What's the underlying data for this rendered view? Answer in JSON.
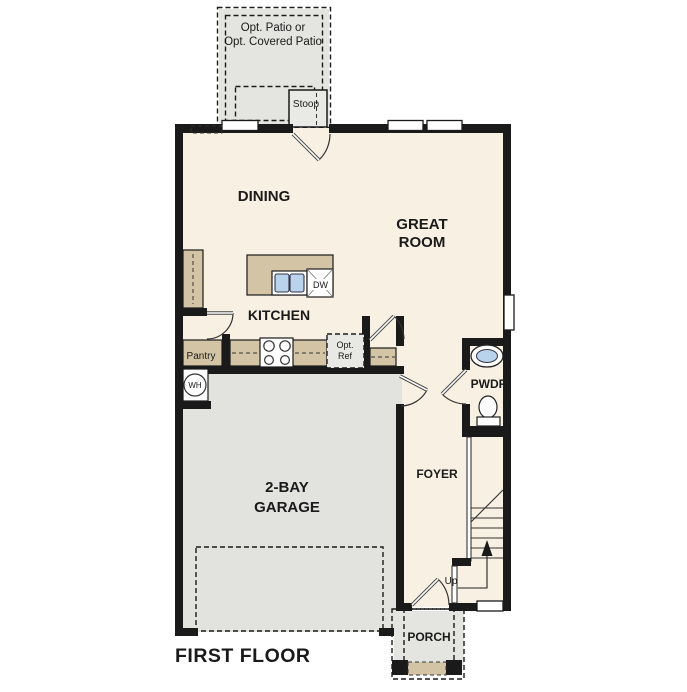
{
  "plan": {
    "title": "FIRST FLOOR",
    "patio": {
      "line1": "Opt. Patio or",
      "line2": "Opt. Covered Patio"
    },
    "stoop": "Stoop",
    "dining": "DINING",
    "great_room": {
      "line1": "GREAT",
      "line2": "ROOM"
    },
    "kitchen": "KITCHEN",
    "pantry": "Pantry",
    "opt_ref": {
      "line1": "Opt.",
      "line2": "Ref"
    },
    "dishwasher": "DW",
    "water_heater": "WH",
    "powder_room": "PWDR",
    "foyer": "FOYER",
    "garage": {
      "line1": "2-BAY",
      "line2": "GARAGE"
    },
    "stairs_up": "Up",
    "porch": "PORCH"
  },
  "colors": {
    "wall": "#1a1a1a",
    "floor": "#f8f0e2",
    "garage_floor": "#e2e2df",
    "cabinet": "#d2c4a4",
    "patio": "#e4e4e1",
    "sink": "#b9d3ec"
  }
}
